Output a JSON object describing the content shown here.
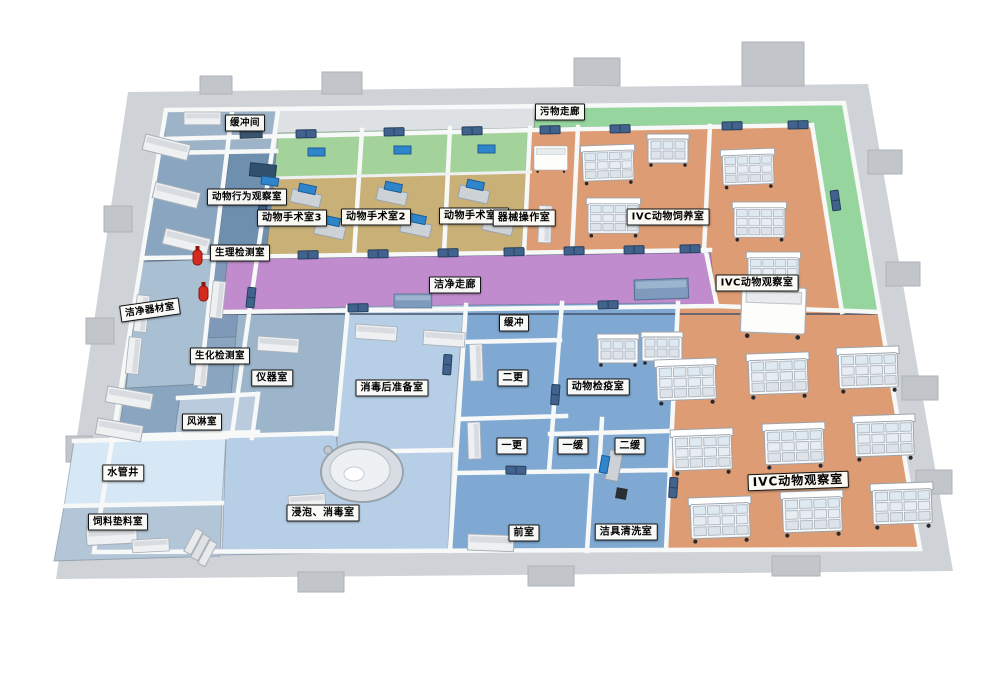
{
  "rooms": [
    {
      "id": "buffer-top",
      "label": "缓冲间"
    },
    {
      "id": "waste-corridor",
      "label": "污物走廊"
    },
    {
      "id": "behavior-observation",
      "label": "动物行为观察室"
    },
    {
      "id": "surgery-3",
      "label": "动物手术室3"
    },
    {
      "id": "surgery-2",
      "label": "动物手术室2"
    },
    {
      "id": "surgery-1",
      "label": "动物手术室1"
    },
    {
      "id": "instrument-operation",
      "label": "器械操作室"
    },
    {
      "id": "ivc-breeding",
      "label": "IVC动物饲养室"
    },
    {
      "id": "physiology-test",
      "label": "生理检测室"
    },
    {
      "id": "clean-equipment",
      "label": "洁净器材室"
    },
    {
      "id": "clean-corridor",
      "label": "洁净走廊"
    },
    {
      "id": "ivc-observation-1",
      "label": "IVC动物观察室"
    },
    {
      "id": "buffer-small",
      "label": "缓冲"
    },
    {
      "id": "biochem-test",
      "label": "生化检测室"
    },
    {
      "id": "instrument-room",
      "label": "仪器室"
    },
    {
      "id": "second-change",
      "label": "二更"
    },
    {
      "id": "animal-quarantine",
      "label": "动物检疫室"
    },
    {
      "id": "post-disinfection-prep",
      "label": "消毒后准备室"
    },
    {
      "id": "air-shower",
      "label": "风淋室"
    },
    {
      "id": "first-change",
      "label": "一更"
    },
    {
      "id": "first-buffer",
      "label": "一缓"
    },
    {
      "id": "second-buffer",
      "label": "二缓"
    },
    {
      "id": "water-shaft",
      "label": "水管井"
    },
    {
      "id": "ivc-observation-2",
      "label": "IVC动物观察室"
    },
    {
      "id": "soak-disinfection",
      "label": "浸泡、消毒室"
    },
    {
      "id": "feed-bedding",
      "label": "饲料垫料室"
    },
    {
      "id": "antechamber",
      "label": "前室"
    },
    {
      "id": "cleaning-tools",
      "label": "洁具清洗室"
    }
  ],
  "colors": {
    "clean_corridor_purple": "#c08ccd",
    "waste_corridor_green": "#96d59e",
    "surgery_green_band": "#a4d29b",
    "surgery_floor_tan": "#c9b077",
    "ivc_floor_orange": "#dd9c73",
    "changing_zone_blue": "#7fa9d2",
    "prep_zone_light_blue": "#b7cfe6",
    "lab_zone_steel_blue": "#8aa5bf",
    "water_shaft_pale_blue": "#d6e8f5",
    "outer_wall_gray": "#cfd3d7",
    "door_blue": "#41628c",
    "monitor_blue": "#2f85cc",
    "extinguisher_red": "#d42b1f"
  }
}
